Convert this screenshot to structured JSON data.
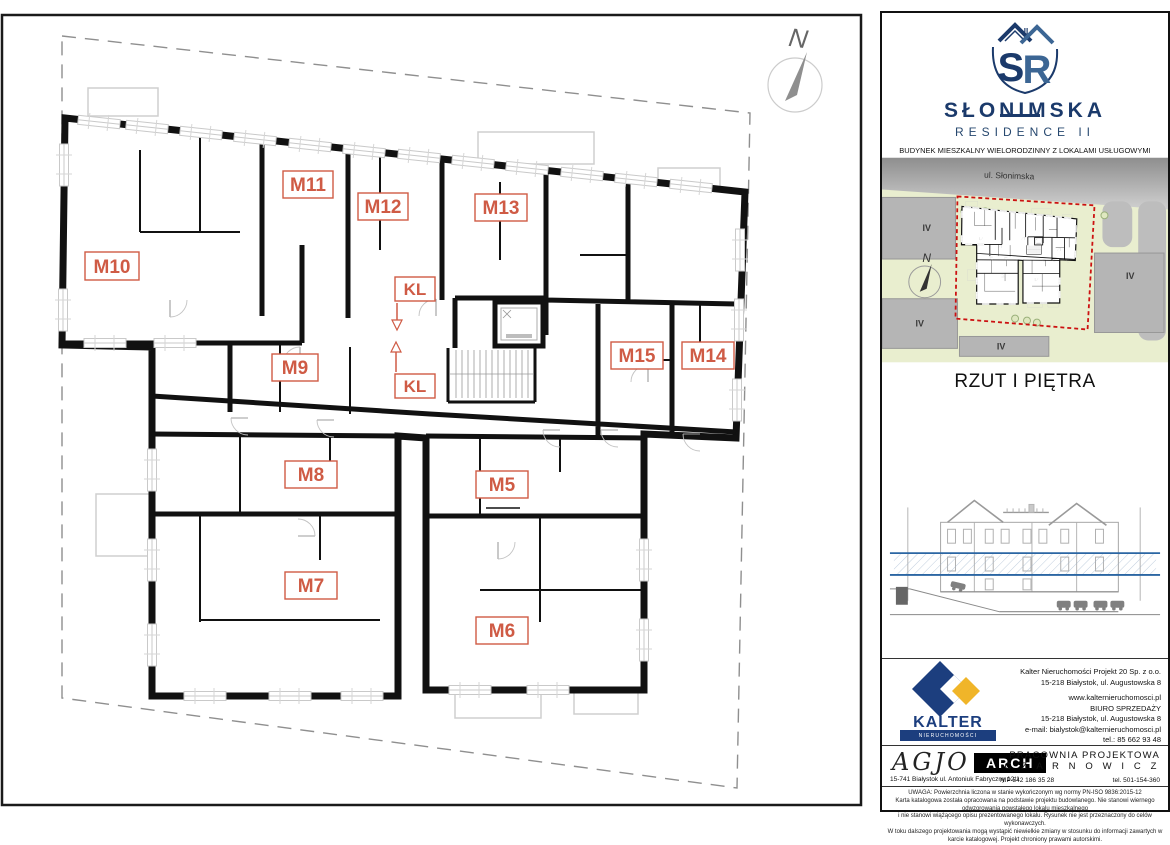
{
  "plan": {
    "units": [
      {
        "label": "M10"
      },
      {
        "label": "M11"
      },
      {
        "label": "M12"
      },
      {
        "label": "M13"
      },
      {
        "label": "M9"
      },
      {
        "label": "M15"
      },
      {
        "label": "M14"
      },
      {
        "label": "M8"
      },
      {
        "label": "M5"
      },
      {
        "label": "M7"
      },
      {
        "label": "M6"
      }
    ],
    "kl": [
      {
        "label": "KL"
      },
      {
        "label": "KL"
      }
    ],
    "north_label": "N",
    "label_color": "#cf5b45"
  },
  "sidebar": {
    "logo": {
      "monogram_s": "S",
      "monogram_r": "R",
      "monogram_ii": "II",
      "name": "SŁONIMSKA",
      "residence": "RESIDENCE II",
      "subtitle": "BUDYNEK MIESZKALNY WIELORODZINNY Z LOKALAMI USŁUGOWYMI",
      "address": "ul. Słonimska 26, 15-029 Białystok",
      "navy": "#1b3a6b",
      "steel": "#3c6694"
    },
    "site_map": {
      "street": "ul. Słonimska",
      "north_label": "N",
      "blocks": [
        "IV",
        "IV",
        "IV",
        "IV"
      ],
      "boundary_color": "#cc1111",
      "green": "#e9eecf"
    },
    "title": "RZUT I PIĘTRA",
    "developer": {
      "name": "KALTER",
      "tagline": "nieruchomości",
      "navy": "#1c3e7e",
      "yellow": "#f0b529",
      "lines": [
        "Kalter Nieruchomości Projekt 20  Sp. z o.o.",
        "15-218 Białystok, ul. Augustowska 8",
        "www.kalternieruchomosci.pl",
        "BIURO SPRZEDAŻY",
        "15-218 Białystok, ul. Augustowska 8",
        "e-mail: bialystok@kalternieruchomosci.pl",
        "tel.: 85 662 93 48"
      ]
    },
    "architects": {
      "script": "AGJO",
      "badge": "ARCH",
      "address": "15-741 Białystok   ul. Antoniuk Fabryczny  12/1",
      "office1": "PRACOWNIA PROJEKTOWA",
      "office2": "C Z A R N O W I C Z",
      "nip": "NIP  542 186 35 28",
      "tel": "tel. 501-154-360"
    },
    "disclaimer": {
      "lines": [
        "UWAGA:  Powierzchnia liczona w stanie wykończonym wg normy PN-ISO 9836:2015-12",
        "Karta katalogowa została opracowana na podstawie projektu budowlanego.  Nie stanowi wiernego odwzorowania powstałego lokalu mieszkalnego",
        "i nie stanowi wiążącego opisu prezentowanego lokalu. Rysunek nie jest przeznaczony do celów wykonawczych.",
        "W toku dalszego projektowania mogą wystąpić niewielkie zmiany w stosunku do informacji zawartych w karcie katalogowej.  Projekt chroniony prawami autorskimi."
      ]
    }
  }
}
